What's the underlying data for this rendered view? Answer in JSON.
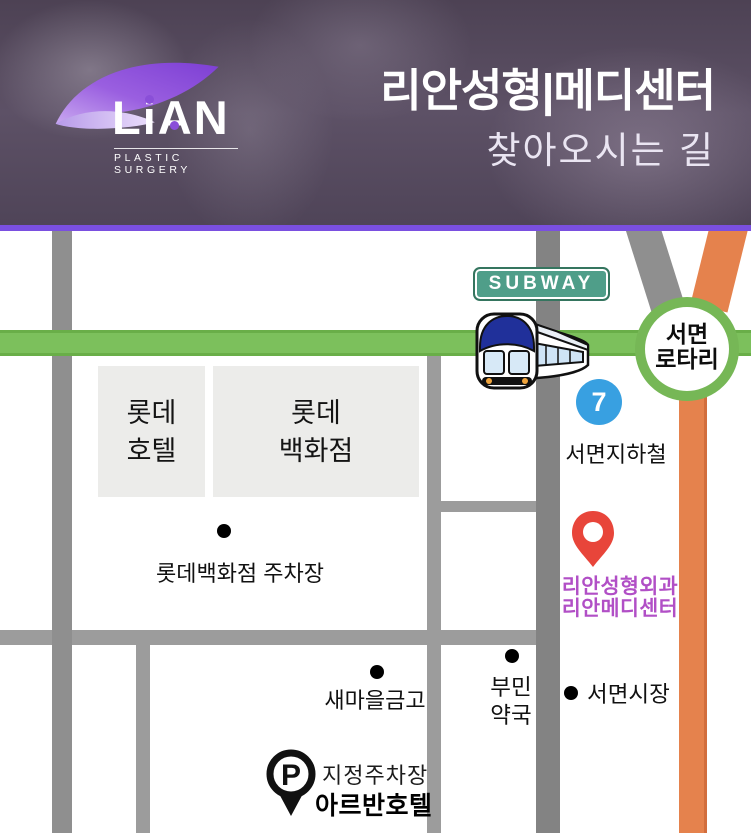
{
  "header": {
    "logo_name": "LiAN",
    "logo_tagline": "PLASTIC SURGERY",
    "title": "리안성형|메디센터",
    "subtitle": "찾아오시는 길"
  },
  "map": {
    "subway_sign_label": "SUBWAY",
    "rotary_line1": "서면",
    "rotary_line2": "로타리",
    "station_badge_number": "7",
    "station_label": "서면지하철",
    "building_hotel_line1": "롯데",
    "building_hotel_line2": "호텔",
    "building_dept_line1": "롯데",
    "building_dept_line2": "백화점",
    "poi_parking_label": "롯데백화점 주차장",
    "poi_saemaul_label": "새마을금고",
    "poi_pharmacy_line1": "부민",
    "poi_pharmacy_line2": "약국",
    "poi_market_label": "서면시장",
    "clinic_line1": "리안성형외과",
    "clinic_line2": "리안메디센터",
    "parking_pin_letter": "P",
    "parking_label": "지정주차장",
    "parking_hotel_label": "아르반호텔"
  },
  "colors": {
    "accent_purple": "#7a4fe0",
    "road_green": "#7cc05c",
    "road_orange": "#e5824d",
    "road_gray": "#8f8f8f",
    "rotary_ring_green": "#76b756",
    "subway_sign_teal": "#4f9e89",
    "station_badge_blue": "#38a0e1",
    "clinic_pin_red": "#e8453a",
    "clinic_text_magenta": "#b14fc6"
  }
}
